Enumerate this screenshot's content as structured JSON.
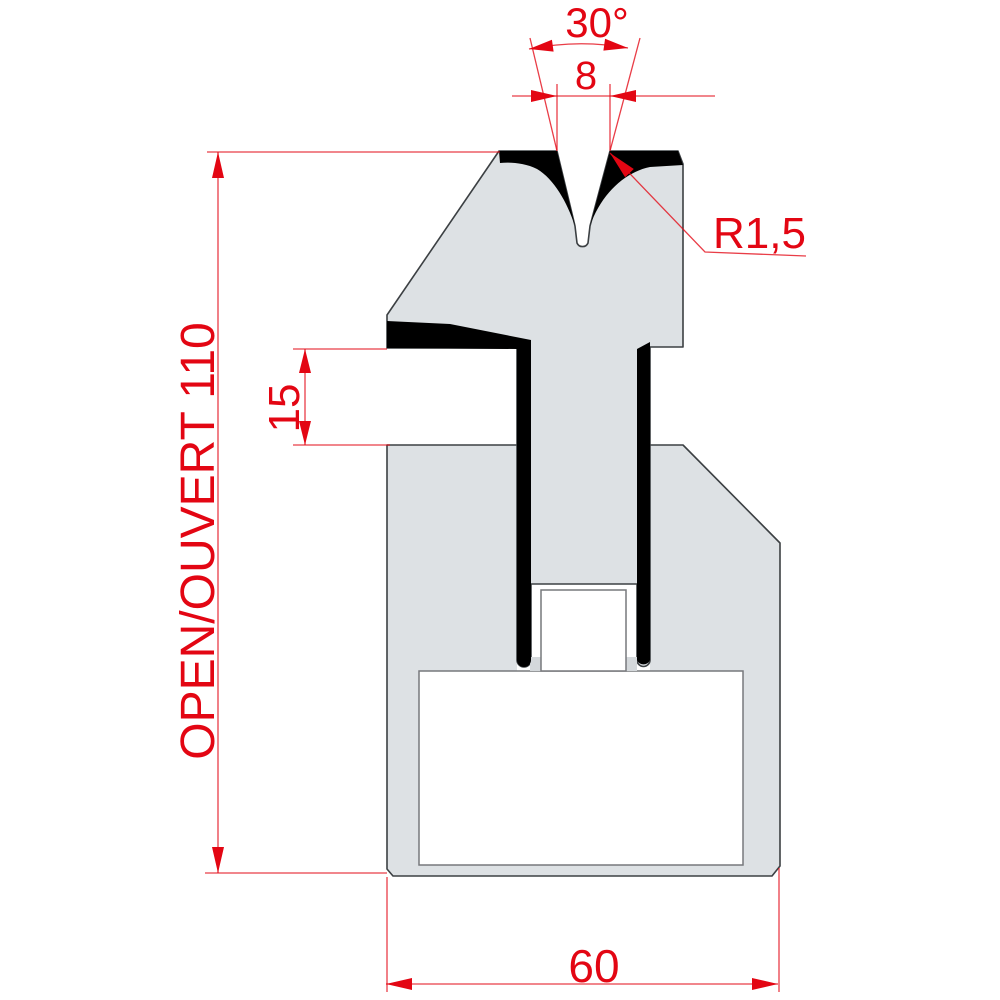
{
  "drawing": {
    "description_labels": {
      "angle": "30°",
      "vee_width": "8",
      "radius": "R1,5",
      "shoulder_gap": "15",
      "open_height": "OPEN/OUVERT 110",
      "base_width": "60"
    },
    "colors": {
      "dimension_red": "#e30613",
      "body_gray": "#dde1e4",
      "outline_dark": "#3c4043",
      "inner_line_gray": "#77797c",
      "coating_black": "#000000",
      "background": "#ffffff"
    }
  }
}
